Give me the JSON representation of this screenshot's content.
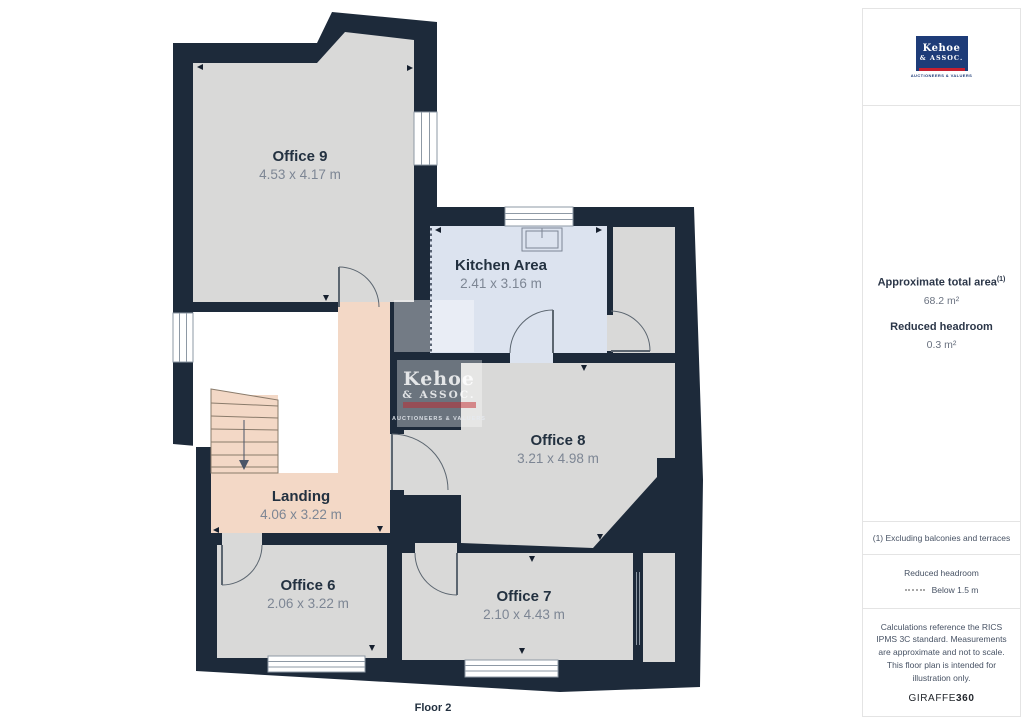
{
  "floor_plan": {
    "floor_label": "Floor 2",
    "rooms": [
      {
        "name": "Office 9",
        "dimensions": "4.53 x 4.17 m"
      },
      {
        "name": "Kitchen Area",
        "dimensions": "2.41 x 3.16 m"
      },
      {
        "name": "Office 8",
        "dimensions": "3.21 x 4.98 m"
      },
      {
        "name": "Landing",
        "dimensions": "4.06 x 3.22 m"
      },
      {
        "name": "Office 6",
        "dimensions": "2.06 x 3.22 m"
      },
      {
        "name": "Office 7",
        "dimensions": "2.10 x 4.43 m"
      }
    ],
    "watermark": {
      "line1": "Kehoe",
      "line2": "& ASSOC.",
      "line3": "AUCTIONEERS & VALUERS"
    }
  },
  "sidebar": {
    "logo": {
      "line1": "Kehoe",
      "line2": "& ASSOC.",
      "caption": "AUCTIONEERS & VALUERS"
    },
    "summary": {
      "area_label": "Approximate total area",
      "area_sup": "(1)",
      "area_value": "68.2 m²",
      "headroom_label": "Reduced headroom",
      "headroom_value": "0.3 m²"
    },
    "footnote": "(1) Excluding balconies and terraces",
    "legend": {
      "title": "Reduced headroom",
      "item": "Below 1.5 m"
    },
    "disclaimer": "Calculations reference the RICS IPMS 3C standard. Measurements are approximate and not to scale. This floor plan is intended for illustration only.",
    "brand": {
      "name": "GIRAFFE",
      "suffix": "360"
    }
  },
  "colors": {
    "wall": "#1d2a3a",
    "room_fill": "#d9d9d8",
    "kitchen_fill": "#dce3ef",
    "landing_fill": "#f3d8c6",
    "logo_navy": "#1e3c78",
    "brand_red": "#c8202f"
  }
}
